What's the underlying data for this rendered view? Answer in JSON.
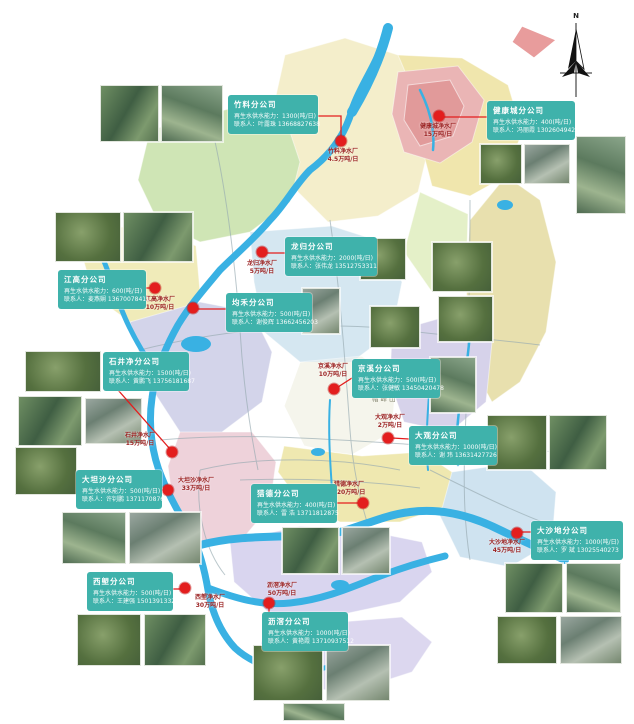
{
  "compass": {
    "label": "N"
  },
  "map_labels": {
    "mountain": "帽峰山"
  },
  "colors": {
    "callout_bg": "#3fb2ab",
    "marker_red": "#e31e1e",
    "river_blue": "#39b1e3"
  },
  "branches": [
    {
      "name": "竹料分公司",
      "capacity": "再生水供水能力：1300(吨/日)",
      "contact": "联系人：叶露珠 13668827638",
      "plant": "竹料净水厂",
      "plant_capacity": "4.5万吨/日"
    },
    {
      "name": "健康城分公司",
      "capacity": "再生水供水能力：400(吨/日)",
      "contact": "联系人：冯丽霞 13026049428",
      "plant": "健康城净水厂",
      "plant_capacity": "15万吨/日"
    },
    {
      "name": "江高分公司",
      "capacity": "再生水供水能力：600(吨/日)",
      "contact": "联系人：麦燕娴 13670078411",
      "plant": "江高净水厂",
      "plant_capacity": "10万吨/日"
    },
    {
      "name": "龙归分公司",
      "capacity": "再生水供水能力：2000(吨/日)",
      "contact": "联系人：张伟龙 13512753311",
      "plant": "龙归净水厂",
      "plant_capacity": "5万吨/日"
    },
    {
      "name": "均禾分公司",
      "capacity": "再生水供水能力：500(吨/日)",
      "contact": "联系人：谢俊辉 13662456203",
      "plant": "",
      "plant_capacity": ""
    },
    {
      "name": "石井净分公司",
      "capacity": "再生水供水能力：1500(吨/日)",
      "contact": "联系人：黄鹏飞 13756181687",
      "plant": "石井净水厂",
      "plant_capacity": "15万吨/日"
    },
    {
      "name": "京溪分公司",
      "capacity": "再生水供水能力：500(吨/日)",
      "contact": "联系人：张健敏 13450420478",
      "plant": "京溪净水厂",
      "plant_capacity": "10万吨/日"
    },
    {
      "name": "大观分公司",
      "capacity": "再生水供水能力：1000(吨/日)",
      "contact": "联系人：谢 玮 13631427726",
      "plant": "大观净水厂",
      "plant_capacity": "2万吨/日"
    },
    {
      "name": "大坦沙分公司",
      "capacity": "再生水供水能力：500(吨/日)",
      "contact": "联系人：许钊鹏 13711708761",
      "plant": "大坦沙净水厂",
      "plant_capacity": "33万吨/日"
    },
    {
      "name": "猎德分公司",
      "capacity": "再生水供水能力：400(吨/日)",
      "contact": "联系人：雷 浩 13711812875",
      "plant": "猎德净水厂",
      "plant_capacity": "120万吨/日"
    },
    {
      "name": "大沙地分公司",
      "capacity": "再生水供水能力：1000(吨/日)",
      "contact": "联系人：罗 斌 13025540273",
      "plant": "大沙地净水厂",
      "plant_capacity": "45万吨/日"
    },
    {
      "name": "西塱分公司",
      "capacity": "再生水供水能力：500(吨/日)",
      "contact": "联系人：王建强 15013913321",
      "plant": "西塱净水厂",
      "plant_capacity": "30万吨/日"
    },
    {
      "name": "沥滘分公司",
      "capacity": "再生水供水能力：1000(吨/日)",
      "contact": "联系人：黄艳霞 13710937512",
      "plant": "沥滘净水厂",
      "plant_capacity": "50万吨/日"
    }
  ]
}
